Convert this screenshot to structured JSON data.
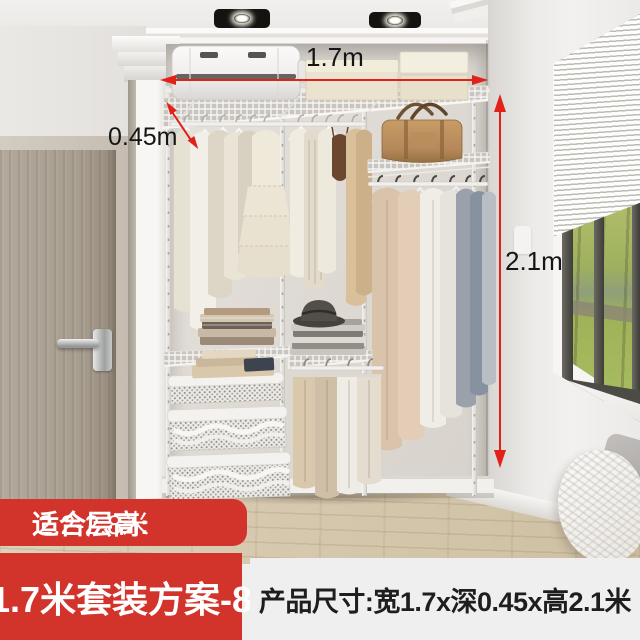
{
  "annotations": {
    "width": "1.7m",
    "depth": "0.45m",
    "height": "2.1m"
  },
  "badge": {
    "label": "适合层高:",
    "value": "2.2-2.8米"
  },
  "footer": {
    "plan_name": "1.7米套装方案-8",
    "product_size": "产品尺寸:宽1.7x深0.45x高2.1米"
  },
  "colors": {
    "accent_red": "#d2342c",
    "arrow_red": "#e2211a",
    "footer_panel_gray": "#efefef",
    "label_text": "#151515",
    "badge_text": "#ffffff"
  }
}
